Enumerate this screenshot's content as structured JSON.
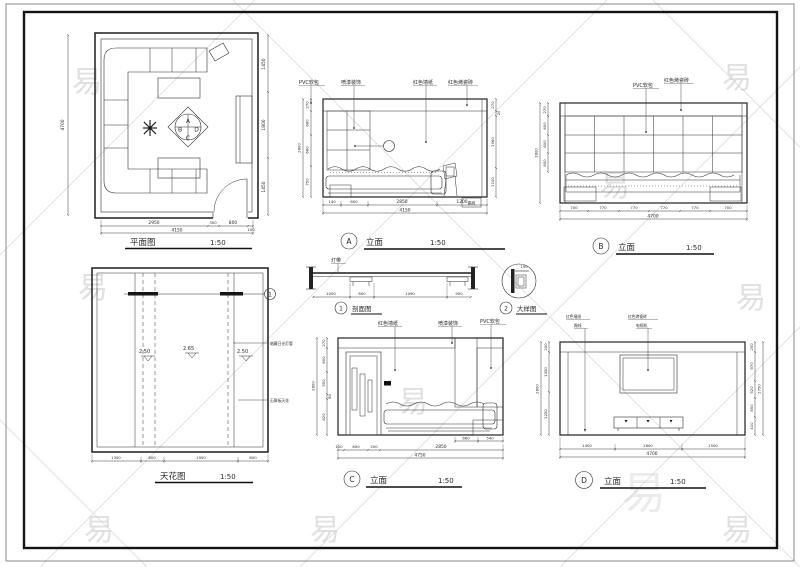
{
  "watermark": {
    "char": "易"
  },
  "plan": {
    "title": "平面图",
    "scale": "1:50",
    "dim_left": "4700",
    "dims_right": [
      "1450",
      "1800",
      "1450"
    ],
    "dims_bottom": [
      "2950",
      "300",
      "800",
      "100"
    ],
    "dim_total": "4150",
    "markers": {
      "top": "A",
      "left": "B",
      "right": "D",
      "bottom": "C"
    }
  },
  "elev_a": {
    "marker": "A",
    "title": "立面",
    "scale": "1:50",
    "labels": [
      "PVC软包",
      "喷漆装饰",
      "红色墙纸",
      "红色烤瓷砖"
    ],
    "note": "踢线",
    "dims_left": [
      "270",
      "680",
      "680",
      "750"
    ],
    "dim_left_total": "2800",
    "dims_right": [
      "270",
      "20",
      "1060",
      "1100"
    ],
    "dims_bottom": [
      "140",
      "600",
      "2850",
      "1200"
    ],
    "dim_total": "4150"
  },
  "elev_b": {
    "marker": "B",
    "title": "立面",
    "scale": "1:50",
    "labels": [
      "PVC软包",
      "红色烤瓷砖"
    ],
    "dims_left": [
      "270",
      "600",
      "600",
      "600"
    ],
    "dim_left_total": "2800",
    "dims_bottom": [
      "700",
      "770",
      "770",
      "770",
      "770",
      "700"
    ],
    "dim_total": "4700"
  },
  "section": {
    "marker": "1",
    "title": "剖面图",
    "label": "灯带",
    "dims": [
      "1000",
      "600",
      "1090",
      "900"
    ]
  },
  "detail": {
    "marker": "2",
    "title": "大样图",
    "dim": "150"
  },
  "ceiling": {
    "title": "天花图",
    "scale": "1:50",
    "levels": [
      "2.50",
      "2.65",
      "2.50"
    ],
    "label_light": "暗藏日光灯管",
    "label_board": "石膏板天花",
    "marker": "1",
    "dims_bottom": [
      "1300",
      "600",
      "1950",
      "800"
    ]
  },
  "elev_c": {
    "marker": "C",
    "title": "立面",
    "scale": "1:50",
    "labels": [
      "红色墙纸",
      "喷漆装饰",
      "PVC软包"
    ],
    "dims_left": [
      "270",
      "600",
      "550",
      "80",
      "620"
    ],
    "dim_left_total": "2800",
    "dims_sofa": [
      "660",
      "540"
    ],
    "dims_bottom": [
      "100",
      "800",
      "200",
      "2850"
    ],
    "dim_total": "4750"
  },
  "elev_d": {
    "marker": "D",
    "title": "立面",
    "scale": "1:50",
    "labels_left": [
      "红色墙纸",
      "踢线"
    ],
    "labels_right": [
      "红色烤瓷砖",
      "电视机"
    ],
    "dims_left": [
      "200",
      "1350",
      "1250"
    ],
    "dim_left_total": "2800",
    "dims_right": [
      "200",
      "970",
      "520",
      "650",
      "410"
    ],
    "dim_right_total": "2750",
    "dims_bottom": [
      "1400",
      "1800",
      "1500"
    ],
    "dim_total": "4700"
  }
}
